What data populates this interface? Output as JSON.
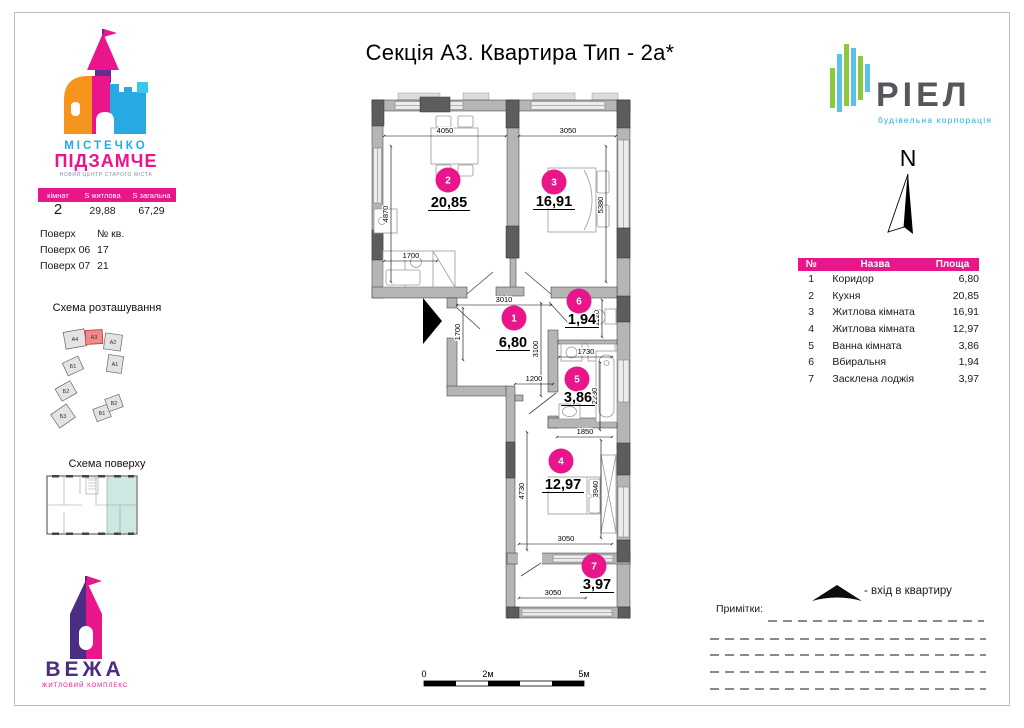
{
  "title": "Секція А3. Квартира Тип - 2а*",
  "podzamche_logo": {
    "line1": "МІСТЕЧКО",
    "line2": "ПІДЗАМЧЕ",
    "tagline": "НОВИЙ ЦЕНТР СТАРОГО МІСТА"
  },
  "summary": {
    "headers": [
      "кімнат",
      "S житлова",
      "S загальна"
    ],
    "rooms": "2",
    "living_area": "29,88",
    "total_area": "67,29"
  },
  "floors": {
    "header_floor": "Поверх",
    "header_apt": "№ кв.",
    "rows": [
      {
        "floor": "Поверх 06",
        "apt": "17"
      },
      {
        "floor": "Поверх 07",
        "apt": "21"
      }
    ]
  },
  "sections": {
    "location_scheme": "Схема розташування",
    "floor_scheme": "Схема поверху"
  },
  "siteplan_blocks": [
    "А4",
    "А3",
    "А2",
    "А1",
    "Б1",
    "Б2",
    "Б3",
    "В1",
    "В2"
  ],
  "vezha_logo": {
    "name": "ВЕЖА",
    "subtitle": "ЖИТЛОВИЙ КОМПЛЕКС"
  },
  "riel_logo": {
    "name": "РІЕЛ",
    "subtitle": "будівельна корпорація"
  },
  "compass": {
    "north": "N"
  },
  "legend": {
    "headers": [
      "№",
      "Назва",
      "Площа"
    ]
  },
  "rooms": [
    {
      "num": "1",
      "name": "Коридор",
      "area": "6,80"
    },
    {
      "num": "2",
      "name": "Кухня",
      "area": "20,85"
    },
    {
      "num": "3",
      "name": "Житлова кімната",
      "area": "16,91"
    },
    {
      "num": "4",
      "name": "Житлова кімната",
      "area": "12,97"
    },
    {
      "num": "5",
      "name": "Ванна кімната",
      "area": "3,86"
    },
    {
      "num": "6",
      "name": "Вбиральня",
      "area": "1,94"
    },
    {
      "num": "7",
      "name": "Засклена лоджія",
      "area": "3,97"
    }
  ],
  "plan_dims": {
    "kitchen_w": "4050",
    "room3_w": "3050",
    "kitchen_h": "4870",
    "room3_h": "5380",
    "counter_w": "1700",
    "hall_w": "3010",
    "hall_h": "1700",
    "hall_len": "3100",
    "hall_w2": "1200",
    "wc_h": "1120",
    "bath_w": "1730",
    "bath_h": "2230",
    "bath_w2": "1850",
    "room4_h_left": "4730",
    "room4_h_right": "3940",
    "room4_w": "3050",
    "loggia_w": "3050"
  },
  "entrance": {
    "label": "-  вхід в квартиру"
  },
  "notes": {
    "label": "Примітки:"
  },
  "scalebar": {
    "zero": "0",
    "two": "2м",
    "five": "5м"
  },
  "colors": {
    "accent_magenta": "#e8158b",
    "brand_blue": "#27aae1",
    "brand_purple": "#4b2e83",
    "brand_orange": "#f7941e",
    "riel_green": "#8dc63f",
    "riel_blue": "#5bc2e7",
    "highlight_red": "#ee8a8a",
    "highlight_teal": "#cde7e2",
    "wall_gray": "#b5b5b5"
  }
}
